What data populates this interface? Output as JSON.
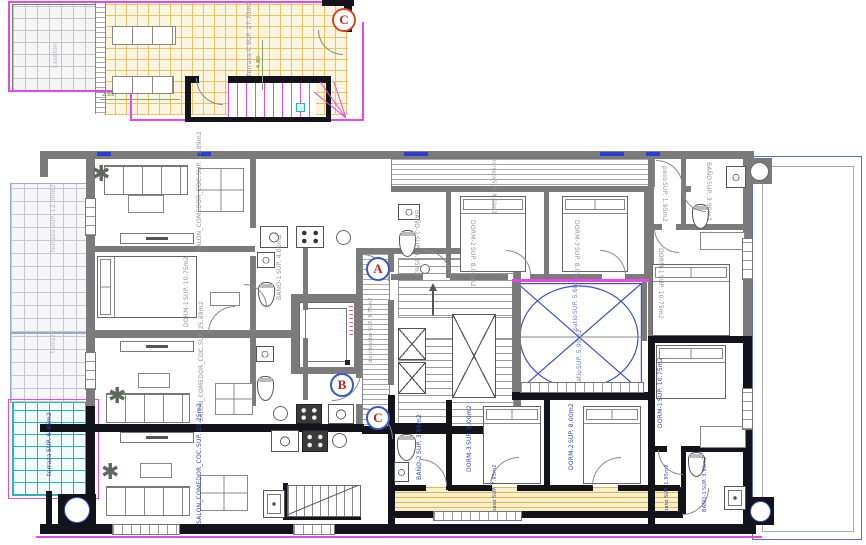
{
  "icons": {
    "plant": "✱"
  },
  "markers": {
    "a": "A",
    "b": "B",
    "c": "C",
    "c_top": "C"
  },
  "top_section": {
    "terraza_roof": {
      "name": "terraza-C",
      "sup": "SUP. 27.75m2"
    },
    "caseton": {
      "name": "casetón",
      "sup": ""
    },
    "dims": {
      "d1": "2.69",
      "d2": "4.80"
    }
  },
  "rooms": {
    "salon_a": {
      "name": "SALON_COMEDOR_COC.",
      "sup": "SUP. 25.89m2"
    },
    "dorm1_a": {
      "name": "DORM-1",
      "sup": "SUP. 10.75m2"
    },
    "bano1_a": {
      "name": "BAÑO-1",
      "sup": "SUP. 4.05m2"
    },
    "terraza_l1": {
      "name": "terraza",
      "sup": "SUP. 12.00m2"
    },
    "terraza_l2": {
      "name": "terraza",
      "sup": ""
    },
    "salon_b": {
      "name": "SALON_COMEDOR_COC.",
      "sup": "SUP. 25.89m2"
    },
    "terraza_b": {
      "name": "terraza",
      "sup": "SUP. 9.60m2"
    },
    "bano2_b": {
      "name": "BAÑO-2",
      "sup": "SUP. 4.05m2"
    },
    "dorm2_b": {
      "name": "DORM-2",
      "sup": "SUP. 8.05m2"
    },
    "dorm3_b": {
      "name": "DORM-3",
      "sup": "SUP. 8.05m2"
    },
    "paso_b": {
      "name": "paso",
      "sup": "SUP. 1.95m2"
    },
    "bano_b": {
      "name": "BAÑO",
      "sup": "SUP. 3.90m2"
    },
    "dorm1_b": {
      "name": "DORM-1",
      "sup": "SUP. 10.75m2"
    },
    "distribuidor": {
      "name": "distribuidor",
      "sup": "SUP. 9.75m2"
    },
    "patio1": {
      "name": "patio",
      "sup": "SUP. 5.68m2"
    },
    "patio2": {
      "name": "patio",
      "sup": "SUP. 5.99m2"
    },
    "salon_c": {
      "name": "SALON_COMEDOR_COC.",
      "sup": "SUP. 25.25m2"
    },
    "terraza_cyan": {
      "name": "terraza",
      "sup": "SUP. 6.45m2"
    },
    "bano2_c": {
      "name": "BAÑO-2",
      "sup": "SUP. 3.95m2"
    },
    "dorm3_c": {
      "name": "DORM-3",
      "sup": "SUP. 8.00m2"
    },
    "dorm2_c": {
      "name": "DORM-2",
      "sup": "SUP. 8.00m2"
    },
    "paso_y": {
      "name": "paso",
      "sup": "SUP. 7.95m2"
    },
    "dorm1_c": {
      "name": "DORM-1",
      "sup": "SUP. 10.75m2"
    },
    "bano1_c": {
      "name": "BAÑO-1",
      "sup": "SUP. 3.90m2"
    },
    "paso_c": {
      "name": "paso",
      "sup": "SUP. 1.95m2"
    }
  },
  "colors": {
    "wall_gray": "#7b7b7b",
    "wall_black": "#13131b",
    "magenta": "#e549e5",
    "yellow_hatch": "#e7c462",
    "cyan_hatch": "#2ab5b5",
    "blue_patio": "#3a4fd0",
    "label_gray": "#8a8f9a",
    "label_blue": "#3342b0",
    "marker_letter": "#c0241c",
    "marker_ring": "#3a55c8",
    "marker_ring_top": "#d2491e"
  }
}
